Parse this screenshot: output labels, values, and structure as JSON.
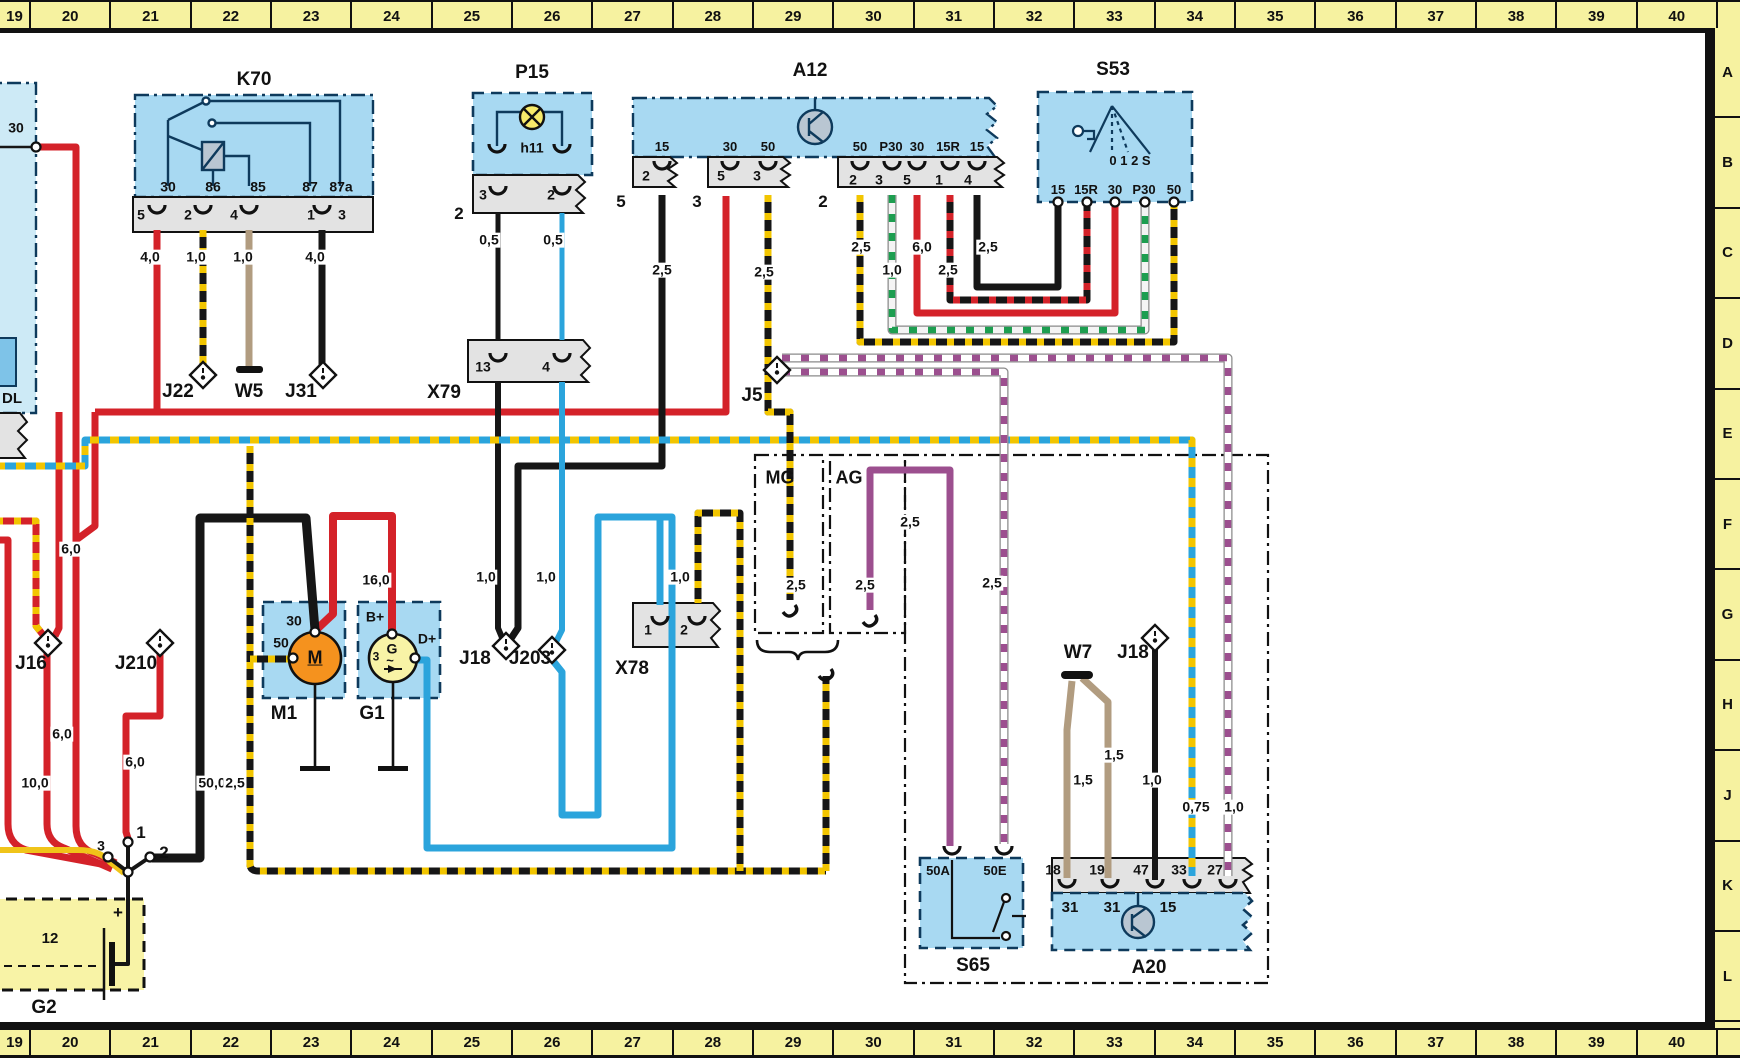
{
  "meta": {
    "type": "automotive wiring diagram",
    "grid_columns": "19-40",
    "grid_rows": "A-L"
  },
  "palette": {
    "component_fill": "#a8d9f2",
    "component_fill_pale": "#cdeaf6",
    "strip_fill": "#e3e3e3",
    "ruler_yellow": "#f6f2a0",
    "battery_yellow": "#f8f3a6",
    "wire_red": "#d42229",
    "wire_black": "#161616",
    "wire_blue": "#2ba4dc",
    "wire_tan": "#b19c80",
    "wire_purple": "#9c4f8f",
    "stripe_yellow": "#f2c500",
    "stripe_green": "#1d9e50",
    "motor_orange": "#f5921e",
    "lamp_yellow": "#f7ea6a",
    "symbol_gray": "#b9c6d2"
  },
  "top_ruler": [
    "19",
    "20",
    "21",
    "22",
    "23",
    "24",
    "25",
    "26",
    "27",
    "28",
    "29",
    "30",
    "31",
    "32",
    "33",
    "34",
    "35",
    "36",
    "37",
    "38",
    "39",
    "40"
  ],
  "bottom_ruler": [
    "19",
    "20",
    "21",
    "22",
    "23",
    "24",
    "25",
    "26",
    "27",
    "28",
    "29",
    "30",
    "31",
    "32",
    "33",
    "34",
    "35",
    "36",
    "37",
    "38",
    "39",
    "40"
  ],
  "side_ruler": [
    "A",
    "B",
    "C",
    "D",
    "E",
    "F",
    "G",
    "H",
    "J",
    "K",
    "L"
  ],
  "labels": [
    {
      "n": "k70-title",
      "t": "K70",
      "x": 254,
      "y": 80,
      "fs": 19
    },
    {
      "n": "p15-title",
      "t": "P15",
      "x": 532,
      "y": 73,
      "fs": 19
    },
    {
      "n": "a12-title",
      "t": "A12",
      "x": 810,
      "y": 71,
      "fs": 19
    },
    {
      "n": "s53-title",
      "t": "S53",
      "x": 1113,
      "y": 70,
      "fs": 19
    },
    {
      "n": "x79-label",
      "t": "X79",
      "x": 444,
      "y": 393,
      "fs": 19
    },
    {
      "n": "x78-label",
      "t": "X78",
      "x": 632,
      "y": 669,
      "fs": 19
    },
    {
      "n": "j22-label",
      "t": "J22",
      "x": 178,
      "y": 392,
      "fs": 19
    },
    {
      "n": "w5-label",
      "t": "W5",
      "x": 249,
      "y": 392,
      "fs": 19
    },
    {
      "n": "j31-label",
      "t": "J31",
      "x": 301,
      "y": 392,
      "fs": 19
    },
    {
      "n": "j5-label",
      "t": "J5",
      "x": 752,
      "y": 396,
      "fs": 19
    },
    {
      "n": "j16-label",
      "t": "J16",
      "x": 31,
      "y": 664,
      "fs": 19
    },
    {
      "n": "j210-label",
      "t": "J210",
      "x": 136,
      "y": 664,
      "fs": 19
    },
    {
      "n": "j18-label",
      "t": "J18",
      "x": 475,
      "y": 659,
      "fs": 19
    },
    {
      "n": "j203-label",
      "t": "J203",
      "x": 530,
      "y": 659,
      "fs": 19
    },
    {
      "n": "w7-label",
      "t": "W7",
      "x": 1078,
      "y": 653,
      "fs": 19
    },
    {
      "n": "j18b-label",
      "t": "J18",
      "x": 1133,
      "y": 653,
      "fs": 19
    },
    {
      "n": "mg-label",
      "t": "MG",
      "x": 780,
      "y": 478,
      "fs": 18
    },
    {
      "n": "ag-label",
      "t": "AG",
      "x": 849,
      "y": 478,
      "fs": 18
    },
    {
      "n": "m1-label",
      "t": "M1",
      "x": 284,
      "y": 714,
      "fs": 19
    },
    {
      "n": "g1-label",
      "t": "G1",
      "x": 372,
      "y": 714,
      "fs": 19
    },
    {
      "n": "g2-label",
      "t": "G2",
      "x": 44,
      "y": 1008,
      "fs": 19
    },
    {
      "n": "s65-label",
      "t": "S65",
      "x": 973,
      "y": 966,
      "fs": 19
    },
    {
      "n": "a20-label",
      "t": "A20",
      "x": 1149,
      "y": 968,
      "fs": 19
    },
    {
      "n": "dl-label",
      "t": "DL",
      "x": 12,
      "y": 399,
      "fs": 15
    },
    {
      "n": "left-terminal-30",
      "t": "30",
      "x": 16,
      "y": 128,
      "fs": 14
    },
    {
      "n": "k70-terminal-30",
      "t": "30",
      "x": 168,
      "y": 187,
      "fs": 14
    },
    {
      "n": "k70-terminal-86",
      "t": "86",
      "x": 213,
      "y": 187,
      "fs": 14
    },
    {
      "n": "k70-terminal-85",
      "t": "85",
      "x": 258,
      "y": 187,
      "fs": 14
    },
    {
      "n": "k70-terminal-87",
      "t": "87",
      "x": 310,
      "y": 187,
      "fs": 14
    },
    {
      "n": "k70-terminal-87a",
      "t": "87a",
      "x": 341,
      "y": 187,
      "fs": 14
    },
    {
      "n": "k70-pin-5",
      "t": "5",
      "x": 141,
      "y": 215,
      "fs": 14
    },
    {
      "n": "k70-pin-2",
      "t": "2",
      "x": 188,
      "y": 215,
      "fs": 14
    },
    {
      "n": "k70-pin-4",
      "t": "4",
      "x": 234,
      "y": 215,
      "fs": 14
    },
    {
      "n": "k70-pin-1",
      "t": "1",
      "x": 311,
      "y": 215,
      "fs": 14
    },
    {
      "n": "k70-pin-3",
      "t": "3",
      "x": 342,
      "y": 215,
      "fs": 14
    },
    {
      "n": "gauge-k70-30",
      "t": "4,0",
      "x": 150,
      "y": 257,
      "fs": 14,
      "bg": 1
    },
    {
      "n": "gauge-k70-86",
      "t": "1,0",
      "x": 196,
      "y": 257,
      "fs": 14,
      "bg": 1
    },
    {
      "n": "gauge-k70-85",
      "t": "1,0",
      "x": 243,
      "y": 257,
      "fs": 14,
      "bg": 1
    },
    {
      "n": "gauge-k70-87",
      "t": "4,0",
      "x": 315,
      "y": 257,
      "fs": 14,
      "bg": 1
    },
    {
      "n": "p15-lamp-id",
      "t": "h11",
      "x": 532,
      "y": 148,
      "fs": 14
    },
    {
      "n": "p15-pin-3",
      "t": "3",
      "x": 483,
      "y": 195,
      "fs": 14
    },
    {
      "n": "p15-pin-2",
      "t": "2",
      "x": 551,
      "y": 195,
      "fs": 14
    },
    {
      "n": "p15-connector-2",
      "t": "2",
      "x": 459,
      "y": 214,
      "fs": 17
    },
    {
      "n": "gauge-p15-3",
      "t": "0,5",
      "x": 489,
      "y": 240,
      "fs": 14,
      "bg": 1
    },
    {
      "n": "gauge-p15-2",
      "t": "0,5",
      "x": 553,
      "y": 240,
      "fs": 14,
      "bg": 1
    },
    {
      "n": "a12-terminal-15a",
      "t": "15",
      "x": 662,
      "y": 147,
      "fs": 13
    },
    {
      "n": "a12-terminal-30a",
      "t": "30",
      "x": 730,
      "y": 147,
      "fs": 13
    },
    {
      "n": "a12-terminal-50a",
      "t": "50",
      "x": 768,
      "y": 147,
      "fs": 13
    },
    {
      "n": "a12-terminal-50b",
      "t": "50",
      "x": 860,
      "y": 147,
      "fs": 13
    },
    {
      "n": "a12-terminal-p30",
      "t": "P30",
      "x": 891,
      "y": 147,
      "fs": 13
    },
    {
      "n": "a12-terminal-30b",
      "t": "30",
      "x": 917,
      "y": 147,
      "fs": 13
    },
    {
      "n": "a12-terminal-15r",
      "t": "15R",
      "x": 948,
      "y": 147,
      "fs": 13
    },
    {
      "n": "a12-terminal-15b",
      "t": "15",
      "x": 977,
      "y": 147,
      "fs": 13
    },
    {
      "n": "a12-pin-2a",
      "t": "2",
      "x": 646,
      "y": 176,
      "fs": 14
    },
    {
      "n": "a12-pin-5a",
      "t": "5",
      "x": 721,
      "y": 176,
      "fs": 14
    },
    {
      "n": "a12-pin-3a",
      "t": "3",
      "x": 757,
      "y": 176,
      "fs": 14
    },
    {
      "n": "a12-pin-2b",
      "t": "2",
      "x": 853,
      "y": 180,
      "fs": 14
    },
    {
      "n": "a12-pin-3b",
      "t": "3",
      "x": 879,
      "y": 180,
      "fs": 14
    },
    {
      "n": "a12-pin-5b",
      "t": "5",
      "x": 907,
      "y": 180,
      "fs": 14
    },
    {
      "n": "a12-pin-1",
      "t": "1",
      "x": 939,
      "y": 180,
      "fs": 14
    },
    {
      "n": "a12-pin-4",
      "t": "4",
      "x": 968,
      "y": 180,
      "fs": 14
    },
    {
      "n": "a12-connector-5",
      "t": "5",
      "x": 621,
      "y": 202,
      "fs": 17
    },
    {
      "n": "a12-connector-3",
      "t": "3",
      "x": 697,
      "y": 202,
      "fs": 17
    },
    {
      "n": "a12-connector-2",
      "t": "2",
      "x": 823,
      "y": 202,
      "fs": 17
    },
    {
      "n": "gauge-a12-15a",
      "t": "2,5",
      "x": 662,
      "y": 270,
      "fs": 14,
      "bg": 1
    },
    {
      "n": "gauge-a12-50a",
      "t": "2,5",
      "x": 764,
      "y": 272,
      "fs": 14,
      "bg": 1
    },
    {
      "n": "gauge-a12-50b",
      "t": "2,5",
      "x": 861,
      "y": 247,
      "fs": 14,
      "bg": 1
    },
    {
      "n": "gauge-a12-p30",
      "t": "1,0",
      "x": 892,
      "y": 270,
      "fs": 14,
      "bg": 1
    },
    {
      "n": "gauge-a12-30b",
      "t": "6,0",
      "x": 922,
      "y": 247,
      "fs": 14,
      "bg": 1
    },
    {
      "n": "gauge-a12-15r",
      "t": "2,5",
      "x": 948,
      "y": 270,
      "fs": 14,
      "bg": 1
    },
    {
      "n": "gauge-a12-15b",
      "t": "2,5",
      "x": 988,
      "y": 247,
      "fs": 14,
      "bg": 1
    },
    {
      "n": "s53-terminal-15",
      "t": "15",
      "x": 1058,
      "y": 190,
      "fs": 13
    },
    {
      "n": "s53-terminal-15r",
      "t": "15R",
      "x": 1086,
      "y": 190,
      "fs": 13
    },
    {
      "n": "s53-terminal-30",
      "t": "30",
      "x": 1115,
      "y": 190,
      "fs": 13
    },
    {
      "n": "s53-terminal-p30",
      "t": "P30",
      "x": 1144,
      "y": 190,
      "fs": 13
    },
    {
      "n": "s53-terminal-50",
      "t": "50",
      "x": 1174,
      "y": 190,
      "fs": 13
    },
    {
      "n": "s53-positions",
      "t": "0 1 2 S",
      "x": 1130,
      "y": 161,
      "fs": 13
    },
    {
      "n": "x79-pin-13",
      "t": "13",
      "x": 483,
      "y": 367,
      "fs": 14
    },
    {
      "n": "x79-pin-4",
      "t": "4",
      "x": 546,
      "y": 367,
      "fs": 14
    },
    {
      "n": "x78-pin-1",
      "t": "1",
      "x": 648,
      "y": 630,
      "fs": 14
    },
    {
      "n": "x78-pin-2",
      "t": "2",
      "x": 684,
      "y": 630,
      "fs": 14
    },
    {
      "n": "m1-terminal-30",
      "t": "30",
      "x": 294,
      "y": 621,
      "fs": 14
    },
    {
      "n": "m1-terminal-50",
      "t": "50",
      "x": 281,
      "y": 643,
      "fs": 14
    },
    {
      "n": "m1-letter",
      "t": "M",
      "x": 315,
      "y": 658,
      "fs": 18,
      "u": 1
    },
    {
      "n": "g1-terminal-bplus",
      "t": "B+",
      "x": 375,
      "y": 617,
      "fs": 14
    },
    {
      "n": "g1-terminal-dplus",
      "t": "D+",
      "x": 427,
      "y": 639,
      "fs": 14
    },
    {
      "n": "g1-letter",
      "t": "G",
      "x": 392,
      "y": 649,
      "fs": 14
    },
    {
      "n": "g1-pin-3",
      "t": "3",
      "x": 376,
      "y": 657,
      "fs": 12
    },
    {
      "n": "g1-sine",
      "t": "~",
      "x": 390,
      "y": 661,
      "fs": 13
    },
    {
      "n": "gauge-left-a",
      "t": "6,0",
      "x": 71,
      "y": 549,
      "fs": 14,
      "bg": 1
    },
    {
      "n": "gauge-left-b",
      "t": "6,0",
      "x": 62,
      "y": 734,
      "fs": 14,
      "bg": 1
    },
    {
      "n": "gauge-j210",
      "t": "6,0",
      "x": 135,
      "y": 762,
      "fs": 14,
      "bg": 1
    },
    {
      "n": "gauge-left-c",
      "t": "10,0",
      "x": 35,
      "y": 783,
      "fs": 14,
      "bg": 1
    },
    {
      "n": "gauge-left-d",
      "t": "10,0",
      "x": -14,
      "y": 783,
      "fs": 14,
      "bg": 1
    },
    {
      "n": "gauge-starter-cable",
      "t": "50,0",
      "x": 212,
      "y": 783,
      "fs": 14,
      "bg": 1
    },
    {
      "n": "gauge-m1-50",
      "t": "2,5",
      "x": 235,
      "y": 783,
      "fs": 14,
      "bg": 1
    },
    {
      "n": "gauge-16-0",
      "t": "16,0",
      "x": 376,
      "y": 580,
      "fs": 14,
      "bg": 1
    },
    {
      "n": "gauge-j18-wire",
      "t": "1,0",
      "x": 486,
      "y": 577,
      "fs": 14,
      "bg": 1
    },
    {
      "n": "gauge-j203-wire",
      "t": "1,0",
      "x": 546,
      "y": 577,
      "fs": 14,
      "bg": 1
    },
    {
      "n": "gauge-x78-wire",
      "t": "1,0",
      "x": 680,
      "y": 577,
      "fs": 14,
      "bg": 1
    },
    {
      "n": "junction-pin-3",
      "t": "3",
      "x": 101,
      "y": 846,
      "fs": 14
    },
    {
      "n": "junction-pin-1",
      "t": "1",
      "x": 141,
      "y": 833,
      "fs": 17
    },
    {
      "n": "junction-pin-2",
      "t": "2",
      "x": 164,
      "y": 853,
      "fs": 17
    },
    {
      "n": "battery-voltage",
      "t": "12",
      "x": 50,
      "y": 939,
      "fs": 15
    },
    {
      "n": "battery-plus",
      "t": "+",
      "x": 118,
      "y": 913,
      "fs": 17
    },
    {
      "n": "gauge-mg-wire",
      "t": "2,5",
      "x": 796,
      "y": 585,
      "fs": 14,
      "bg": 1
    },
    {
      "n": "gauge-ag-wire",
      "t": "2,5",
      "x": 865,
      "y": 585,
      "fs": 14,
      "bg": 1
    },
    {
      "n": "gauge-purple-wire",
      "t": "2,5",
      "x": 910,
      "y": 522,
      "fs": 14,
      "bg": 1
    },
    {
      "n": "gauge-50e-wire",
      "t": "2,5",
      "x": 992,
      "y": 583,
      "fs": 14,
      "bg": 1
    },
    {
      "n": "gauge-a20-33",
      "t": "0,75",
      "x": 1196,
      "y": 807,
      "fs": 14,
      "bg": 1
    },
    {
      "n": "gauge-a20-27",
      "t": "1,0",
      "x": 1234,
      "y": 807,
      "fs": 14,
      "bg": 1
    },
    {
      "n": "gauge-w7-left",
      "t": "1,5",
      "x": 1083,
      "y": 780,
      "fs": 14,
      "bg": 1
    },
    {
      "n": "gauge-w7-right",
      "t": "1,5",
      "x": 1114,
      "y": 755,
      "fs": 14,
      "bg": 1
    },
    {
      "n": "gauge-j18b-wire",
      "t": "1,0",
      "x": 1152,
      "y": 780,
      "fs": 14,
      "bg": 1
    },
    {
      "n": "s65-terminal-50a",
      "t": "50A",
      "x": 938,
      "y": 871,
      "fs": 13
    },
    {
      "n": "s65-terminal-50e",
      "t": "50E",
      "x": 995,
      "y": 871,
      "fs": 13
    },
    {
      "n": "a20-pin-18",
      "t": "18",
      "x": 1053,
      "y": 870,
      "fs": 14
    },
    {
      "n": "a20-pin-19",
      "t": "19",
      "x": 1097,
      "y": 870,
      "fs": 14
    },
    {
      "n": "a20-pin-47",
      "t": "47",
      "x": 1141,
      "y": 870,
      "fs": 14
    },
    {
      "n": "a20-pin-33",
      "t": "33",
      "x": 1179,
      "y": 870,
      "fs": 14
    },
    {
      "n": "a20-pin-27",
      "t": "27",
      "x": 1215,
      "y": 870,
      "fs": 14
    },
    {
      "n": "a20-terminal-31a",
      "t": "31",
      "x": 1070,
      "y": 908,
      "fs": 15
    },
    {
      "n": "a20-terminal-31b",
      "t": "31",
      "x": 1112,
      "y": 908,
      "fs": 15
    },
    {
      "n": "a20-terminal-15",
      "t": "15",
      "x": 1168,
      "y": 908,
      "fs": 15
    }
  ]
}
